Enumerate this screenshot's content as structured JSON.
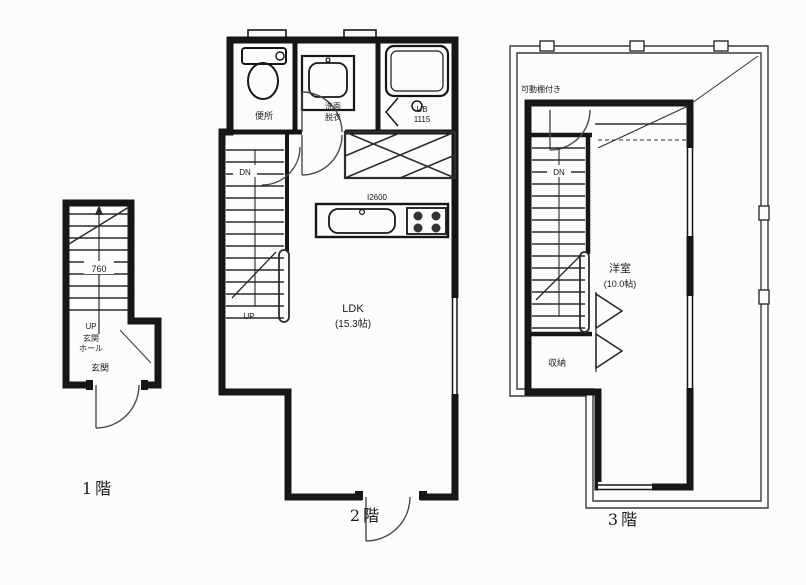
{
  "colors": {
    "ink": "#1b1b1b",
    "paper": "#fcfcfb",
    "thin_line": "#3a3a3a"
  },
  "floor1": {
    "caption": "1階",
    "stair_width": "760",
    "up": "UP",
    "hall_line1": "玄関",
    "hall_line2": "ホール",
    "entry": "玄関"
  },
  "floor2": {
    "caption": "2階",
    "toilet": "便所",
    "wash_line1": "洗面",
    "wash_line2": "脱衣",
    "bath_line1": "UB",
    "bath_line2": "1115",
    "down": "DN",
    "up": "UP",
    "kitchen_size": "I2600",
    "room_line1": "LDK",
    "room_line2": "(15.3帖)"
  },
  "floor3": {
    "caption": "3階",
    "shelf_note": "可動棚付き",
    "down": "DN",
    "closet": "収納",
    "room_line1": "洋室",
    "room_line2": "(10.0帖)"
  }
}
